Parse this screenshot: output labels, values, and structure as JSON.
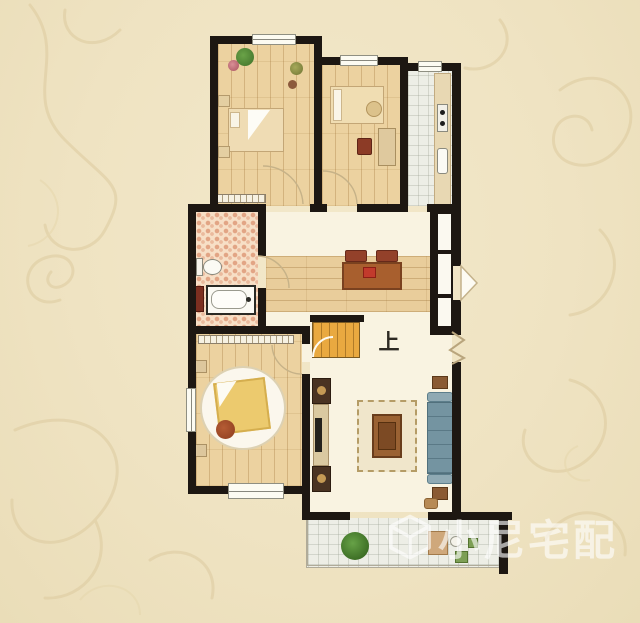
{
  "scene": {
    "type": "apartment-floor-plan",
    "background_color": "#efe3c2",
    "wall_color": "#1d1712"
  },
  "labels": {
    "stairs_up": "上"
  },
  "watermark": {
    "text": "小尼宅配",
    "icon": "cube-logo",
    "color": "#ffffff"
  },
  "palette": {
    "wood_floor": "#ecd2a0",
    "cream_floor": "#f9f3e1",
    "tile_floor": "#edeee6",
    "bathroom_mosaic": "#f7dfc6",
    "stairs": "#e9a940",
    "sofa": "#7494a1",
    "dining_table": "#a85f2e",
    "chair": "#93412a",
    "rug": "#f0e6cb",
    "plant": "#55923c",
    "speaker": "#4a3322",
    "round_bed_quilt": "#ecca6e"
  },
  "rooms": [
    {
      "name": "bedroom-top-left",
      "floor": "wood",
      "items": [
        "double-bed",
        "plants",
        "wardrobe"
      ]
    },
    {
      "name": "bedroom-top-middle",
      "floor": "wood",
      "items": [
        "bed",
        "dresser",
        "chair"
      ]
    },
    {
      "name": "kitchen",
      "floor": "tile",
      "items": [
        "counter",
        "sink",
        "stove"
      ]
    },
    {
      "name": "bathroom",
      "floor": "mosaic",
      "items": [
        "toilet",
        "bathtub",
        "washer"
      ]
    },
    {
      "name": "dining-hall",
      "floor": "wood-strip",
      "items": [
        "dining-table",
        "chairs"
      ]
    },
    {
      "name": "stairwell",
      "label": "上",
      "items": [
        "stairs"
      ]
    },
    {
      "name": "master-bedroom",
      "floor": "wood",
      "items": [
        "round-bed",
        "nightstands",
        "wardrobe",
        "bay-window"
      ]
    },
    {
      "name": "living-room",
      "floor": "cream",
      "items": [
        "tv-cabinet",
        "speakers",
        "rug",
        "coffee-table",
        "sofa",
        "side-tables"
      ]
    },
    {
      "name": "balcony",
      "floor": "tile",
      "items": [
        "plant",
        "table",
        "stools"
      ]
    },
    {
      "name": "entry",
      "items": [
        "door-swing",
        "cabinet-panels"
      ]
    }
  ]
}
